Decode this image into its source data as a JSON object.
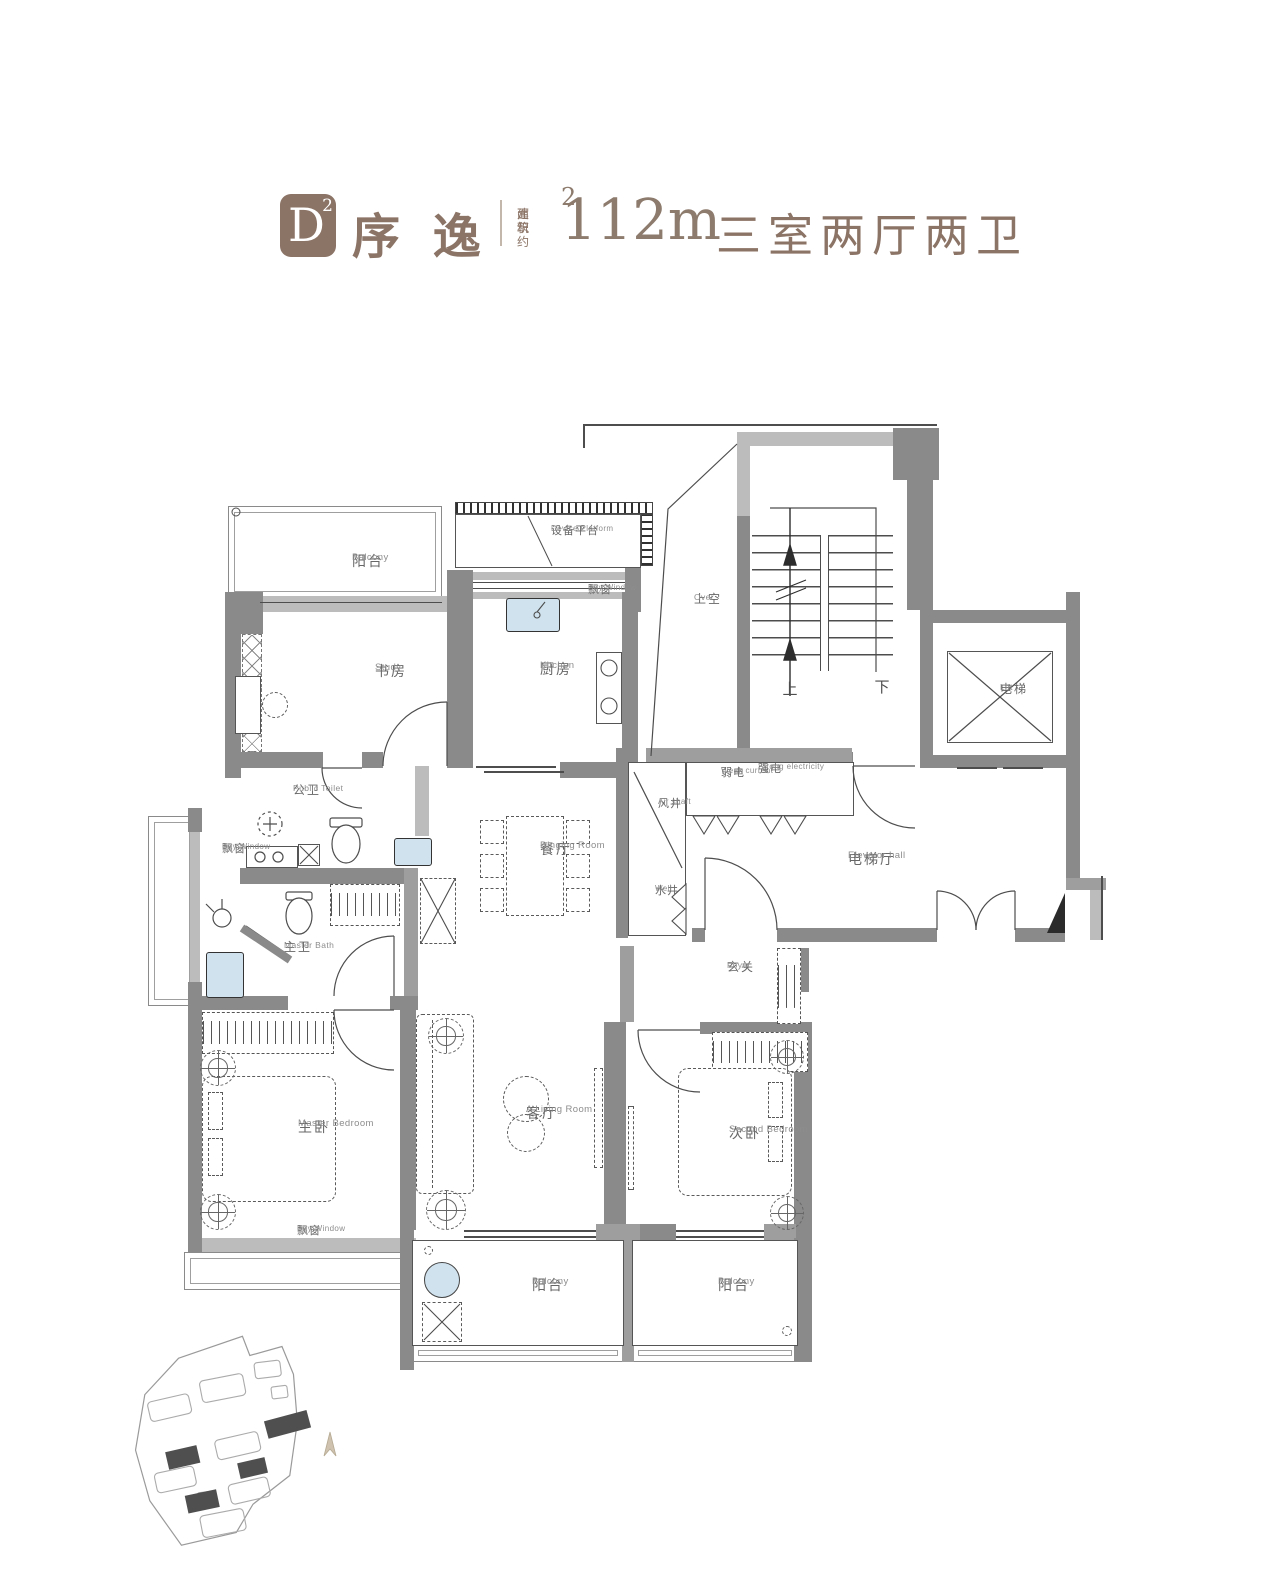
{
  "header": {
    "type_code": "D",
    "type_sup": "2",
    "name": "序 逸",
    "area_label_line1": "建 筑",
    "area_label_line2": "面积约",
    "area_value": "112m",
    "area_sup": "2",
    "layout": "三室两厅两卫",
    "accent_color": "#8B7365"
  },
  "rooms": {
    "balcony_top": {
      "zh": "阳台",
      "en": "Balcony"
    },
    "device_platform": {
      "zh": "设备平台",
      "en": "Device Platform"
    },
    "bay_window_kitchen": {
      "zh": "飘窗",
      "en": "Bay Window"
    },
    "study": {
      "zh": "书房",
      "en": "Study"
    },
    "kitchen": {
      "zh": "厨房",
      "en": "Kitchen"
    },
    "over": {
      "zh": "上空",
      "en": "Over"
    },
    "lift": {
      "zh": "电梯",
      "en": "Lift"
    },
    "public_toilet": {
      "zh": "公卫",
      "en": "Public Toilet"
    },
    "bay_window_left": {
      "zh": "飘窗",
      "en": "Bay Window"
    },
    "weak_current": {
      "zh": "弱电",
      "en": "Weak current"
    },
    "strong_electricity": {
      "zh": "强电",
      "en": "Strong electricity"
    },
    "air_shaft": {
      "zh": "风井",
      "en": "Air shaft"
    },
    "well": {
      "zh": "水井",
      "en": "Well"
    },
    "elevator_hall": {
      "zh": "电梯厅",
      "en": "Elevator hall"
    },
    "dining_room": {
      "zh": "餐厅",
      "en": "Dinging Room"
    },
    "master_bath": {
      "zh": "主卫",
      "en": "Master Bath"
    },
    "foyer": {
      "zh": "玄关",
      "en": "Foyer"
    },
    "master_bedroom": {
      "zh": "主卧",
      "en": "Master Bedroom"
    },
    "living_room": {
      "zh": "客厅",
      "en": "A Living Room"
    },
    "second_bedroom": {
      "zh": "次卧",
      "en": "Second Bedroom"
    },
    "bay_window_bottom": {
      "zh": "飘窗",
      "en": "Bay Window"
    },
    "balcony_bottom_left": {
      "zh": "阳台",
      "en": "Balcony"
    },
    "balcony_bottom_right": {
      "zh": "阳台",
      "en": "Balcony"
    }
  },
  "stairs": {
    "up_label": "上",
    "down_label": "下"
  },
  "colors": {
    "accent": "#8B7365",
    "wall_dark": "#8a8a8a",
    "wall_light": "#bcbcbc",
    "fixture_blue": "#cfe2ee"
  }
}
